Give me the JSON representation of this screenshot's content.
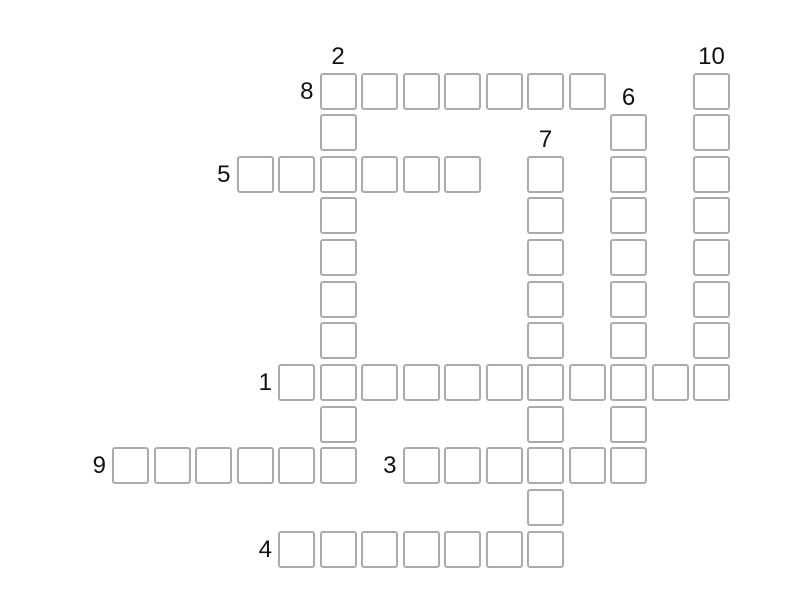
{
  "app": {
    "view": "crossword-puzzle"
  },
  "puzzle": {
    "background_color": "#ffffff",
    "cell_fill_color": "#ffffff",
    "cell_border_color": "#ababab",
    "number_color": "#111111",
    "clue_numbers_visible": [
      "1",
      "2",
      "3",
      "4",
      "5",
      "6",
      "7",
      "8",
      "9",
      "10"
    ],
    "entries": [
      {
        "number": "1",
        "direction": "across",
        "row": 7,
        "col": 4,
        "length": 11
      },
      {
        "number": "2",
        "direction": "down",
        "row": 0,
        "col": 5,
        "length": 10
      },
      {
        "number": "3",
        "direction": "across",
        "row": 9,
        "col": 7,
        "length": 6
      },
      {
        "number": "4",
        "direction": "across",
        "row": 11,
        "col": 4,
        "length": 7
      },
      {
        "number": "5",
        "direction": "across",
        "row": 2,
        "col": 3,
        "length": 6
      },
      {
        "number": "6",
        "direction": "down",
        "row": 1,
        "col": 12,
        "length": 9
      },
      {
        "number": "7",
        "direction": "down",
        "row": 2,
        "col": 10,
        "length": 10
      },
      {
        "number": "8",
        "direction": "across",
        "row": 0,
        "col": 5,
        "length": 7
      },
      {
        "number": "9",
        "direction": "across",
        "row": 9,
        "col": 0,
        "length": 6
      },
      {
        "number": "10",
        "direction": "down",
        "row": 0,
        "col": 14,
        "length": 8
      }
    ]
  }
}
